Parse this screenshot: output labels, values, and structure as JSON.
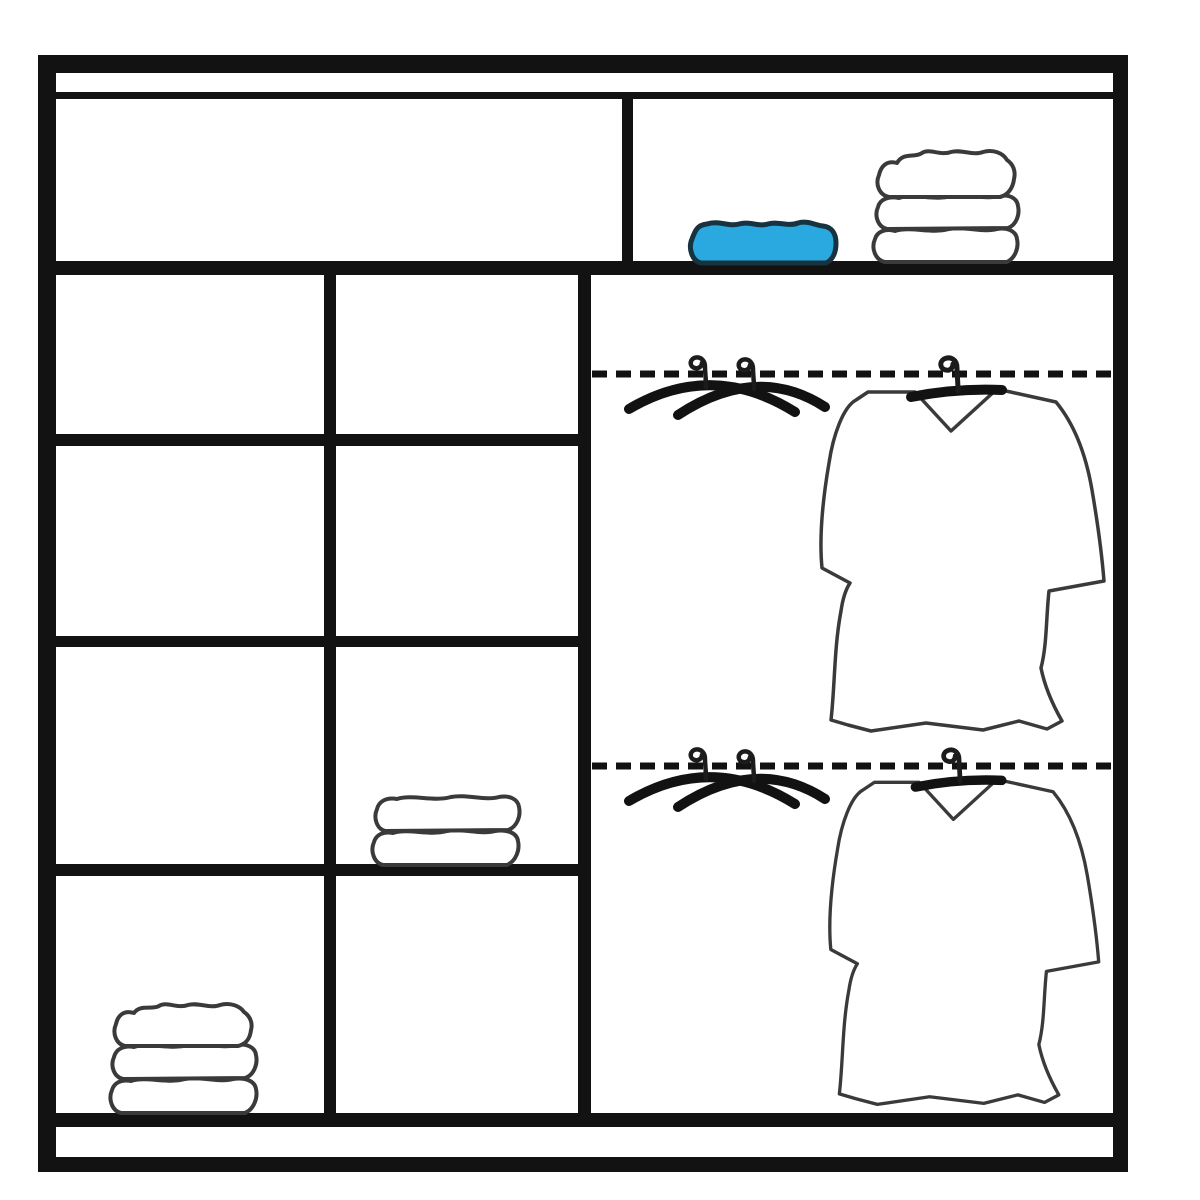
{
  "page": {
    "description": "Black and white line diagram of a sliding-door wardrobe interior: left half has shelved compartments with folded towels, right half has two dashed clothes rails with crossed empty hangers and hanging garments, and a full-width top shelf holding a blue folded towel and a stack of three white towels.",
    "background": "#ffffff"
  },
  "colors": {
    "bg": "#ffffff",
    "ink": "#121212",
    "sketch": "#3a3a3a",
    "towel_blue": "#2aa9e0",
    "towel_blue_ink": "#17333f"
  },
  "wardrobe": {
    "top_shelf": {
      "left_compartment_contents": [],
      "right_compartment_contents": [
        "blue folded towel",
        "stack of 3 white towels"
      ]
    },
    "left_grid": {
      "columns": 2,
      "rows": 4,
      "items": [
        {
          "item": "folded white towel (2 folds)",
          "column": "right",
          "row": 3
        },
        {
          "item": "stack of 3 white towels",
          "column": "left",
          "row": 4
        }
      ]
    },
    "hanging_area": {
      "rails": [
        {
          "position": "upper",
          "style": "dashed",
          "contents": [
            "two crossed empty hangers",
            "garment on hanger"
          ]
        },
        {
          "position": "lower",
          "style": "dashed",
          "contents": [
            "two crossed empty hangers",
            "garment on hanger"
          ]
        }
      ]
    }
  }
}
